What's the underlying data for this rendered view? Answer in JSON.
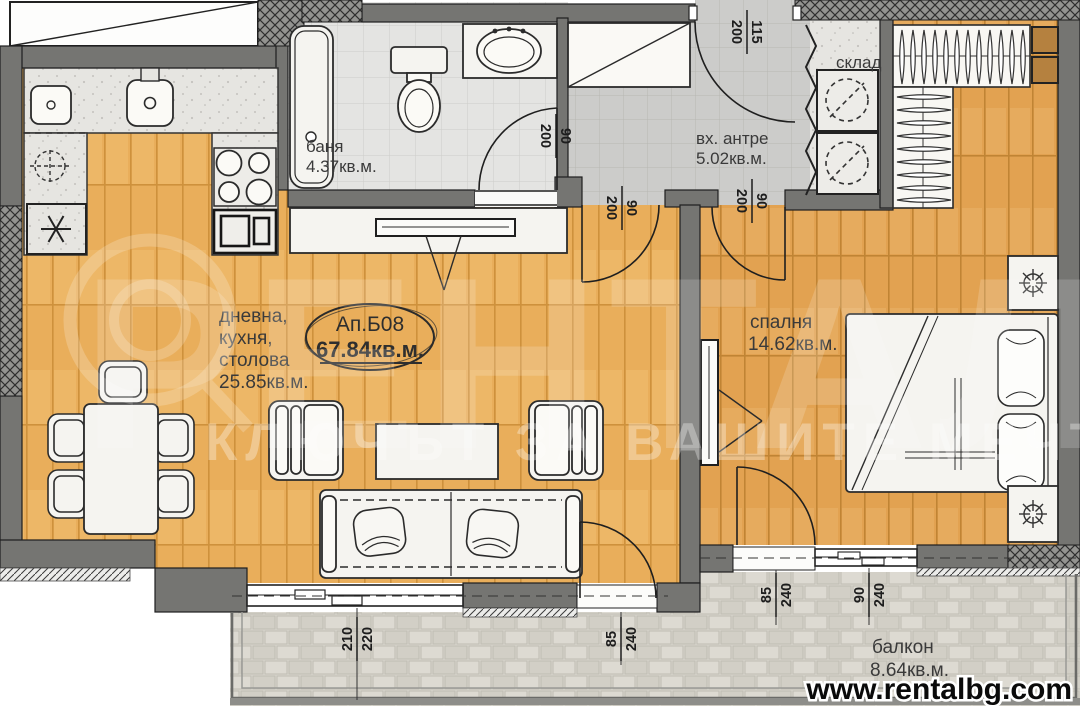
{
  "watermark": {
    "brand": "РЕНТАЛ",
    "slogan": "КЛЮЧЪТ ЗА ВАШИТЕ МЕЧТИ",
    "url": "www.rentalbg.com"
  },
  "unit": {
    "label": "Ап.Б08",
    "area": "67.84кв.м."
  },
  "rooms": {
    "living": {
      "line1": "дневна,",
      "line2": "кухня,",
      "line3": "столова",
      "area": "25.85кв.м."
    },
    "bathroom": {
      "name": "баня",
      "area": "4.37кв.м."
    },
    "hall": {
      "name": "вх. антре",
      "area": "5.02кв.м."
    },
    "storage": {
      "name": "склад"
    },
    "bedroom": {
      "name": "спалня",
      "area": "14.62кв.м."
    },
    "balcony": {
      "name": "балкон",
      "area": "8.64кв.м."
    }
  },
  "dimensions": {
    "entrance_door": {
      "width": "115",
      "height": "200"
    },
    "bathroom_door": {
      "width": "90",
      "height": "200"
    },
    "living_door": {
      "width": "90",
      "height": "200"
    },
    "bedroom_door": {
      "width": "90",
      "height": "200"
    },
    "living_window": {
      "width": "210",
      "height": "220"
    },
    "living_balcony_door": {
      "width": "85",
      "height": "240"
    },
    "bedroom_balcony_door": {
      "width": "85",
      "height": "240"
    },
    "bedroom_window": {
      "width": "90",
      "height": "240"
    }
  },
  "colors": {
    "wall": "#757572",
    "wood_living": "#E9AE5B",
    "wood_bedroom": "#E2A251",
    "tile_bath": "#E4E4E2",
    "tile_hall": "#CCCCCA",
    "balcony_paving": "#D9D6CE",
    "label_text": "#3a3a3a",
    "dimension_text": "#1d1d1d"
  }
}
